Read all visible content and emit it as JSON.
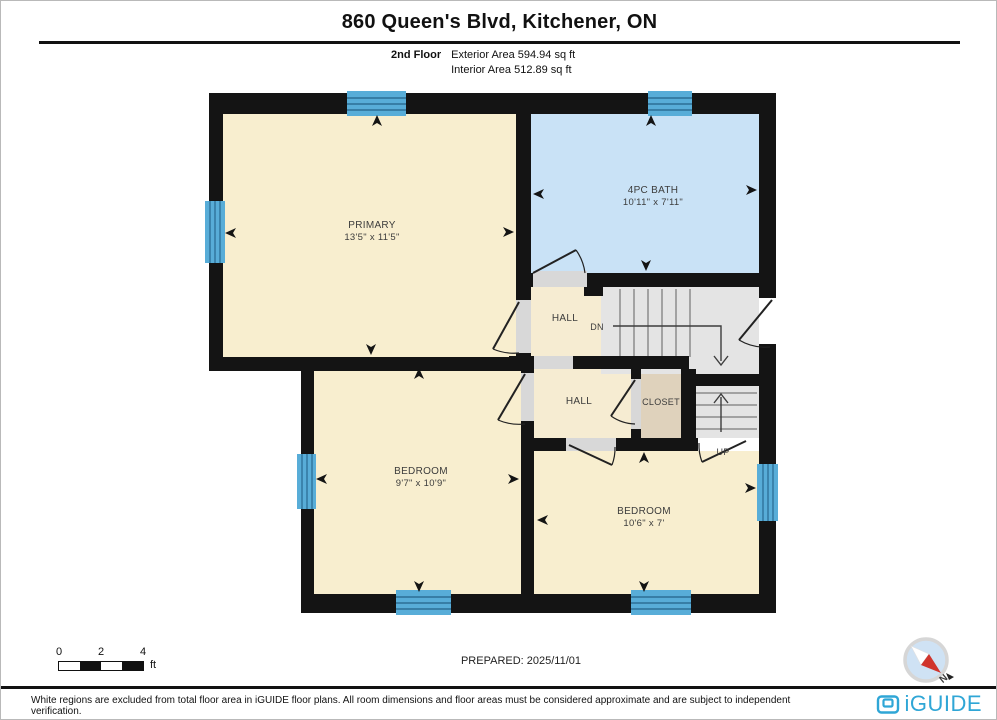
{
  "header": {
    "title": "860 Queen's Blvd, Kitchener, ON",
    "floor_label": "2nd Floor",
    "exterior_area": "Exterior Area 594.94 sq ft",
    "interior_area": "Interior Area 512.89 sq ft"
  },
  "rooms": {
    "primary": {
      "name": "PRIMARY",
      "dims": "13'5\" x 11'5\""
    },
    "bath": {
      "name": "4PC BATH",
      "dims": "10'11\" x 7'11\""
    },
    "bedroom_left": {
      "name": "BEDROOM",
      "dims": "9'7\" x 10'9\""
    },
    "bedroom_right": {
      "name": "BEDROOM",
      "dims": "10'6\" x 7'"
    },
    "hall_upper": {
      "label": "HALL"
    },
    "hall_lower": {
      "label": "HALL"
    },
    "closet": {
      "label": "CLOSET"
    }
  },
  "stairs": {
    "dn_label": "DN",
    "up_label": "UP"
  },
  "scale_bar": {
    "labels": [
      "0",
      "2",
      "4"
    ],
    "unit": "ft"
  },
  "compass": {
    "label": "N"
  },
  "footer": {
    "prepared": "PREPARED: 2025/11/01",
    "disclaimer": "White regions are excluded from total floor area in iGUIDE floor plans. All room dimensions and floor areas must be considered approximate and are subject to independent verification.",
    "brand": "iGUIDE"
  },
  "colors": {
    "wall": "#141414",
    "room_cream": "#f8eecf",
    "bath_blue": "#c9e2f6",
    "window_blue": "#58add8",
    "window_line": "#2c6e96",
    "stairs_gray": "#e4e4e4",
    "threshold_gray": "#d8d8d8",
    "closet_tan": "#dfd2bc",
    "brand_blue": "#2fa6d6",
    "compass_red": "#d0342c"
  }
}
